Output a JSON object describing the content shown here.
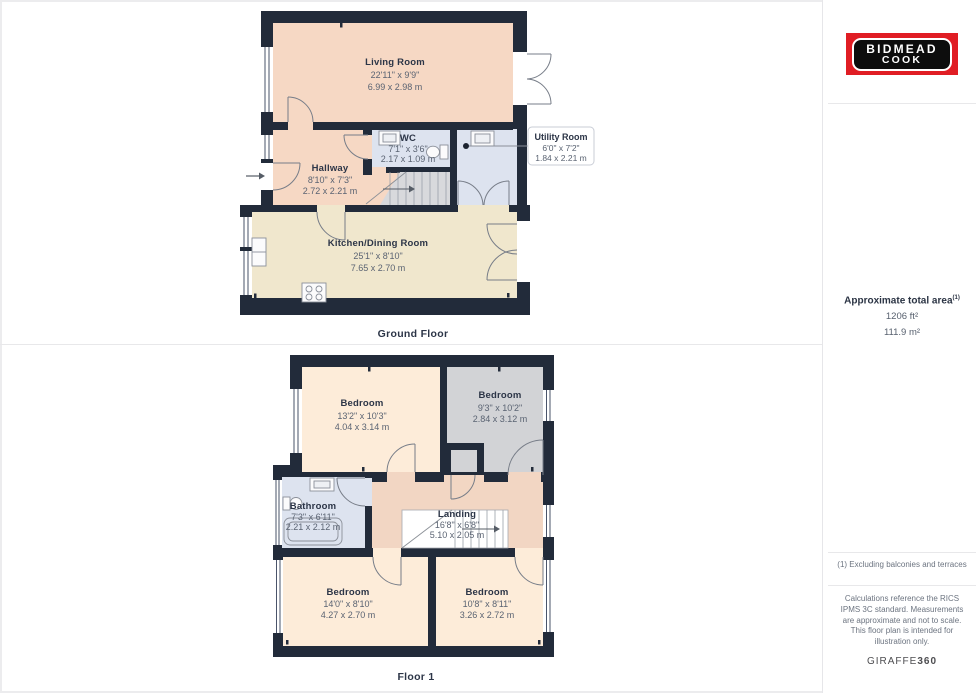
{
  "branding": {
    "agency_line1": "BIDMEAD",
    "agency_line2": "COOK",
    "logo_red": "#e01d24",
    "provider": "GIRAFFE",
    "provider_suffix": "360"
  },
  "floors": [
    {
      "label": "Ground Floor",
      "rooms": [
        {
          "name": "Living Room",
          "imperial": "22'11\" x 9'9\"",
          "metric": "6.99 x 2.98 m"
        },
        {
          "name": "WC",
          "imperial": "7'1\" x 3'6\"",
          "metric": "2.17 x 1.09 m"
        },
        {
          "name": "Hallway",
          "imperial": "8'10\" x 7'3\"",
          "metric": "2.72 x 2.21 m"
        },
        {
          "name": "Utility Room",
          "imperial": "6'0\" x 7'2\"",
          "metric": "1.84 x 2.21 m"
        },
        {
          "name": "Kitchen/Dining Room",
          "imperial": "25'1\" x 8'10\"",
          "metric": "7.65 x 2.70 m"
        }
      ]
    },
    {
      "label": "Floor 1",
      "rooms": [
        {
          "name": "Bedroom",
          "imperial": "13'2\" x 10'3\"",
          "metric": "4.04 x 3.14 m"
        },
        {
          "name": "Bedroom",
          "imperial": "9'3\" x 10'2\"",
          "metric": "2.84 x 3.12 m"
        },
        {
          "name": "Bathroom",
          "imperial": "7'3\" x 6'11\"",
          "metric": "2.21 x 2.12 m"
        },
        {
          "name": "Landing",
          "imperial": "16'8\" x 6'8\"",
          "metric": "5.10 x 2.05 m"
        },
        {
          "name": "Bedroom",
          "imperial": "14'0\" x 8'10\"",
          "metric": "4.27 x 2.70 m"
        },
        {
          "name": "Bedroom",
          "imperial": "10'8\" x 8'11\"",
          "metric": "3.26 x 2.72 m"
        }
      ]
    }
  ],
  "area_summary": {
    "title": "Approximate total area",
    "footnote_marker": "(1)",
    "imperial": "1206 ft²",
    "metric": "111.9 m²"
  },
  "notes": {
    "footnote": "(1) Excluding balconies and terraces",
    "disclaimer": "Calculations reference the RICS IPMS 3C standard. Measurements are approximate and not to scale. This floor plan is intended for illustration only."
  },
  "colors": {
    "wall": "#222b3a",
    "peach": "#f6d8c4",
    "landing_tan": "#f2d6c3",
    "bedroom_cream": "#fdecd9",
    "kitchen_cream": "#f0e7cd",
    "wet_room_blue": "#dde3ef",
    "gray_room": "#d2d3d6"
  }
}
